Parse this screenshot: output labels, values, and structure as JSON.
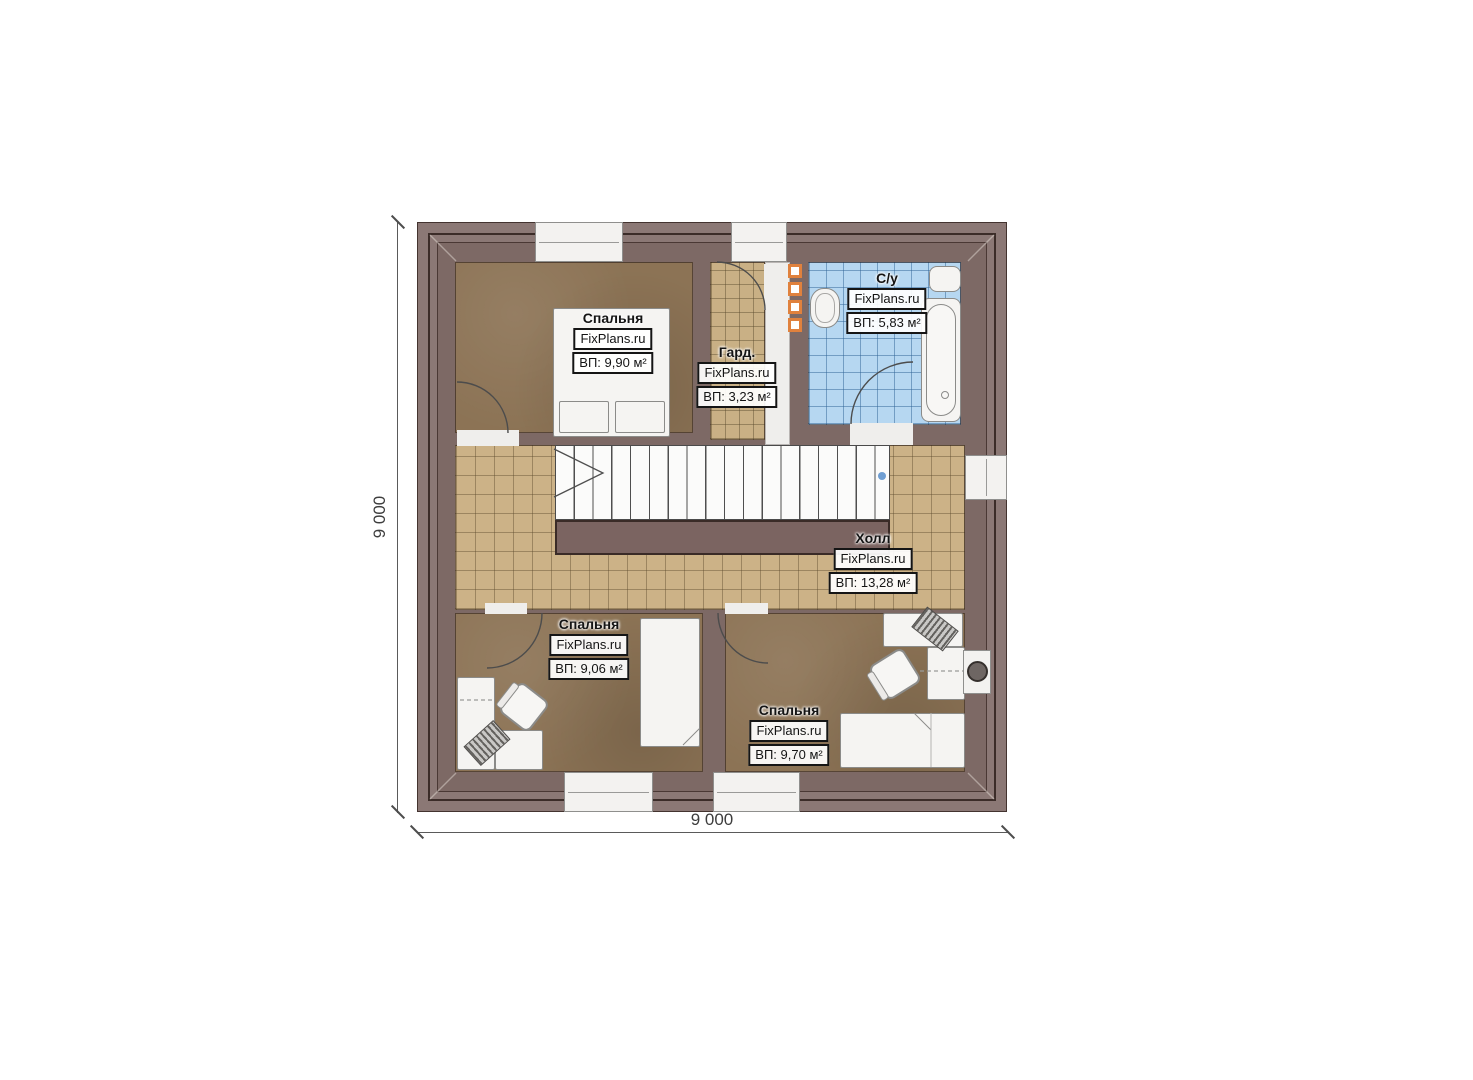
{
  "plan": {
    "dimension_left": "9 000",
    "dimension_bottom": "9 000",
    "rooms": [
      {
        "id": "bedroom-top",
        "name": "Спальня",
        "watermark": "FixPlans.ru",
        "area": "ВП: 9,90 м²"
      },
      {
        "id": "wardrobe",
        "name": "Гард.",
        "watermark": "FixPlans.ru",
        "area": "ВП: 3,23 м²"
      },
      {
        "id": "bathroom",
        "name": "С/у",
        "watermark": "FixPlans.ru",
        "area": "ВП: 5,83 м²"
      },
      {
        "id": "hall",
        "name": "Холл",
        "watermark": "FixPlans.ru",
        "area": "ВП: 13,28 м²"
      },
      {
        "id": "bedroom-left",
        "name": "Спальня",
        "watermark": "FixPlans.ru",
        "area": "ВП: 9,06 м²"
      },
      {
        "id": "bedroom-right",
        "name": "Спальня",
        "watermark": "FixPlans.ru",
        "area": "ВП: 9,70 м²"
      }
    ],
    "colors": {
      "wall": "#7d6965",
      "eaves": "#8b7875",
      "bedroom_floor": "#8c7355",
      "hall_tile": "#ccb287",
      "bath_tile": "#b6d7f1",
      "radiator_accent": "#e0813d",
      "marker_dot": "#6f9ed2"
    }
  }
}
